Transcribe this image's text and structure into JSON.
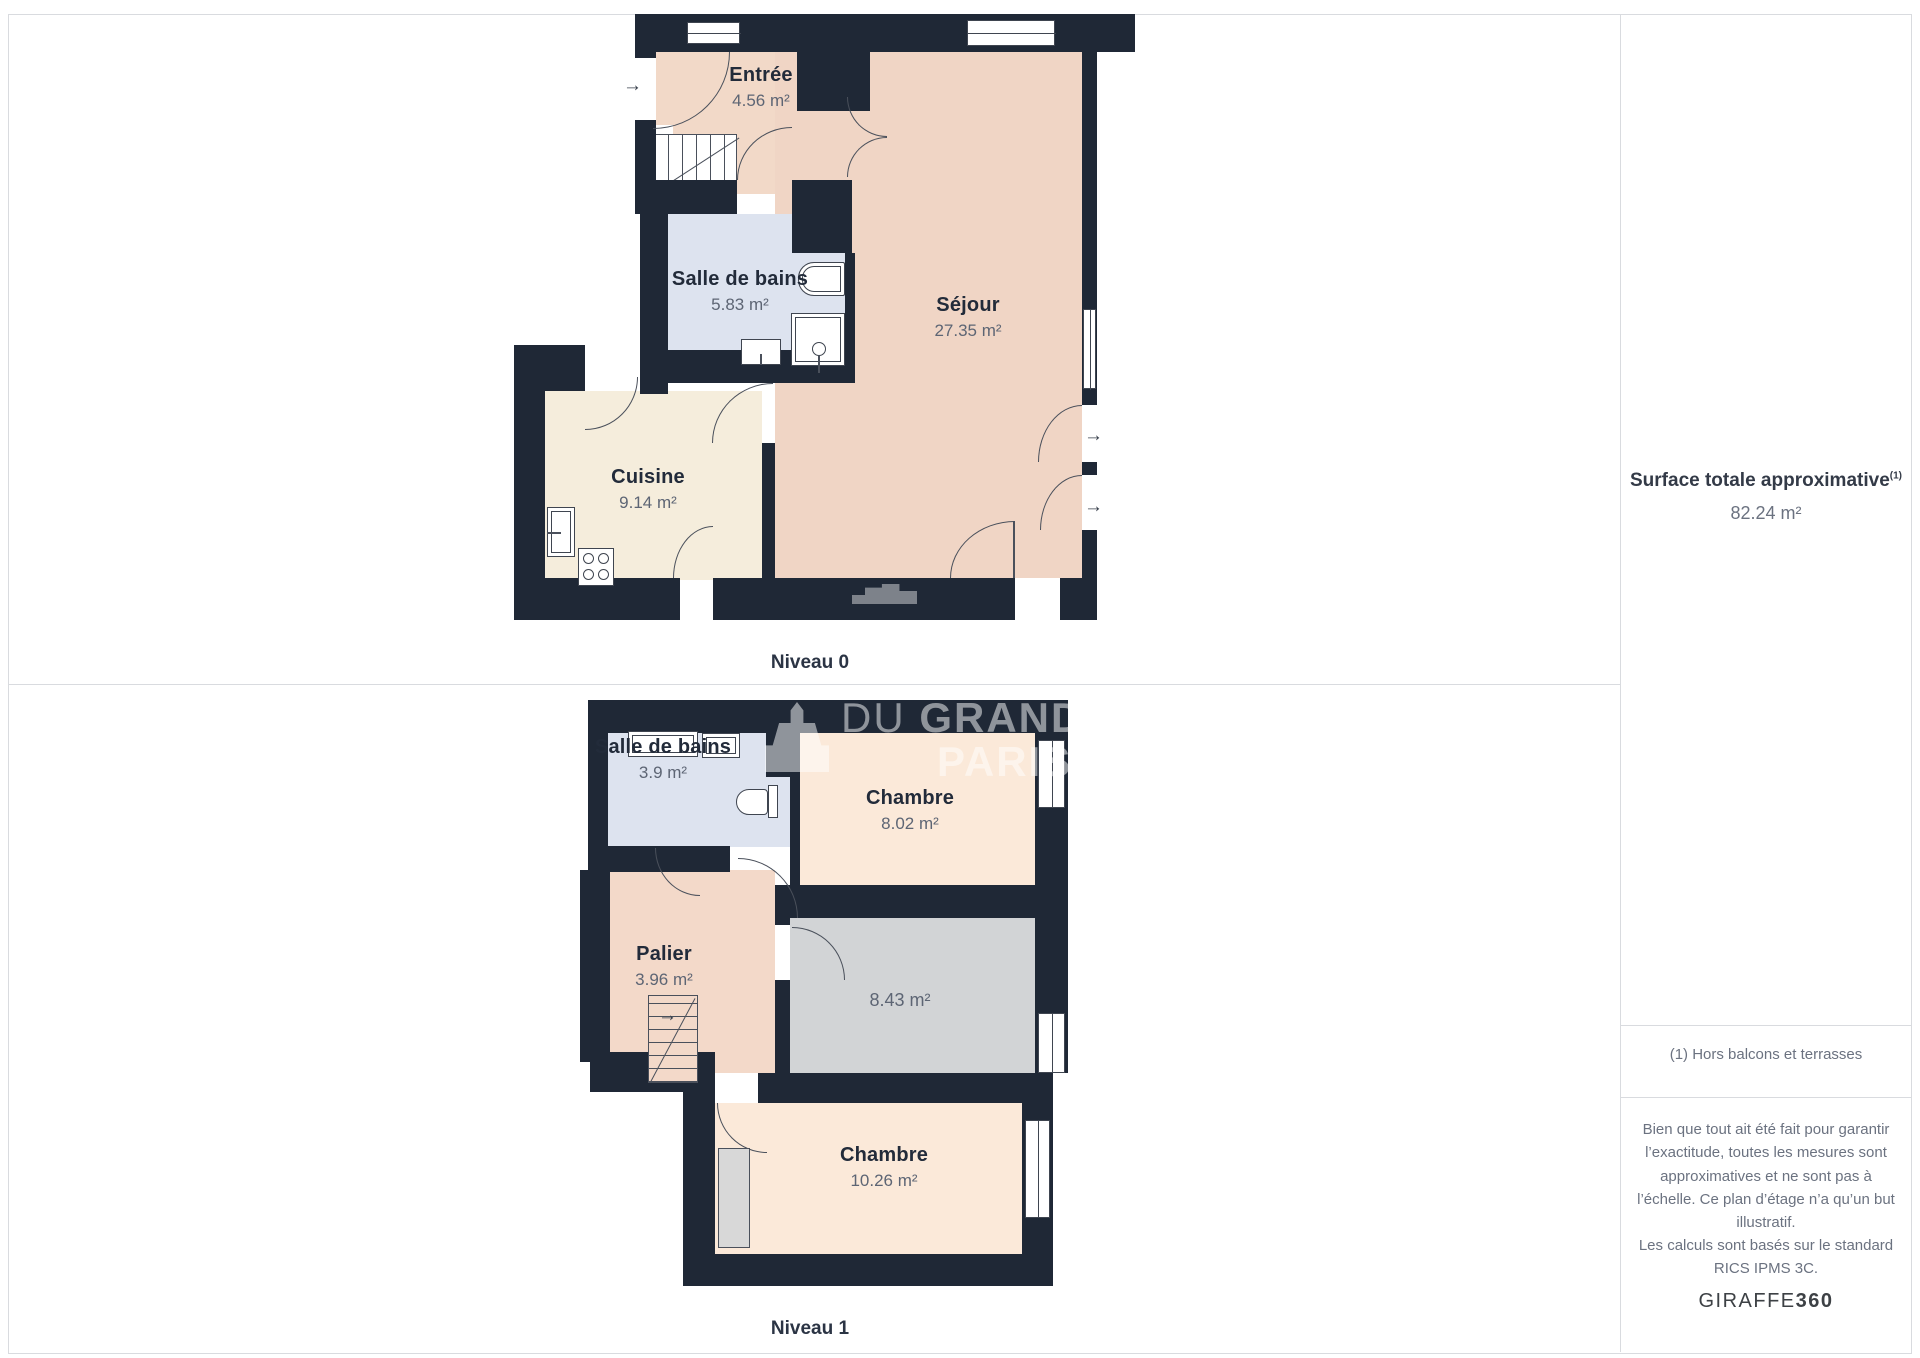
{
  "watermark": {
    "line1_regular": "DU",
    "line1_bold": "GRAND",
    "line2": "PARIS"
  },
  "levels": [
    {
      "name": "Niveau 0",
      "rooms": [
        {
          "name": "Entrée",
          "area": "4.56 m²"
        },
        {
          "name": "Salle de bains",
          "area": "5.83 m²"
        },
        {
          "name": "Séjour",
          "area": "27.35 m²"
        },
        {
          "name": "Cuisine",
          "area": "9.14 m²"
        }
      ]
    },
    {
      "name": "Niveau 1",
      "rooms": [
        {
          "name": "Salle de bains",
          "area": "3.9 m²"
        },
        {
          "name": "Chambre",
          "area": "8.02 m²"
        },
        {
          "name": "Palier",
          "area": "3.96 m²"
        },
        {
          "name": "",
          "area": "8.43 m²"
        },
        {
          "name": "Chambre",
          "area": "10.26 m²"
        }
      ]
    }
  ],
  "sidebar": {
    "title": "Surface totale approximative",
    "title_superscript": "(1)",
    "total_area": "82.24 m²",
    "footnote": "(1) Hors balcons et terrasses",
    "disclaimer_1": "Bien que tout ait été fait pour garantir l’exactitude, toutes les mesures sont approximatives et ne sont pas à l’échelle. Ce plan d’étage n’a qu’un but illustratif.",
    "disclaimer_2": "Les calculs sont basés sur le standard RICS IPMS 3C.",
    "brand_name": "GIRAFFE",
    "brand_suffix": "360"
  },
  "colors": {
    "wall": "#1f2836",
    "sejour": "#f0d5c5",
    "entree": "#f2d9c8",
    "palier": "#f3d9c9",
    "chambre": "#fbe9d9",
    "cuisine": "#f5eddc",
    "bathroom": "#dde3ef",
    "gray_room": "#d2d4d6",
    "line": "#3f4550",
    "frame_border": "#d9dbdf",
    "text_dark": "#222b3a",
    "text_gray": "#5d6574"
  }
}
